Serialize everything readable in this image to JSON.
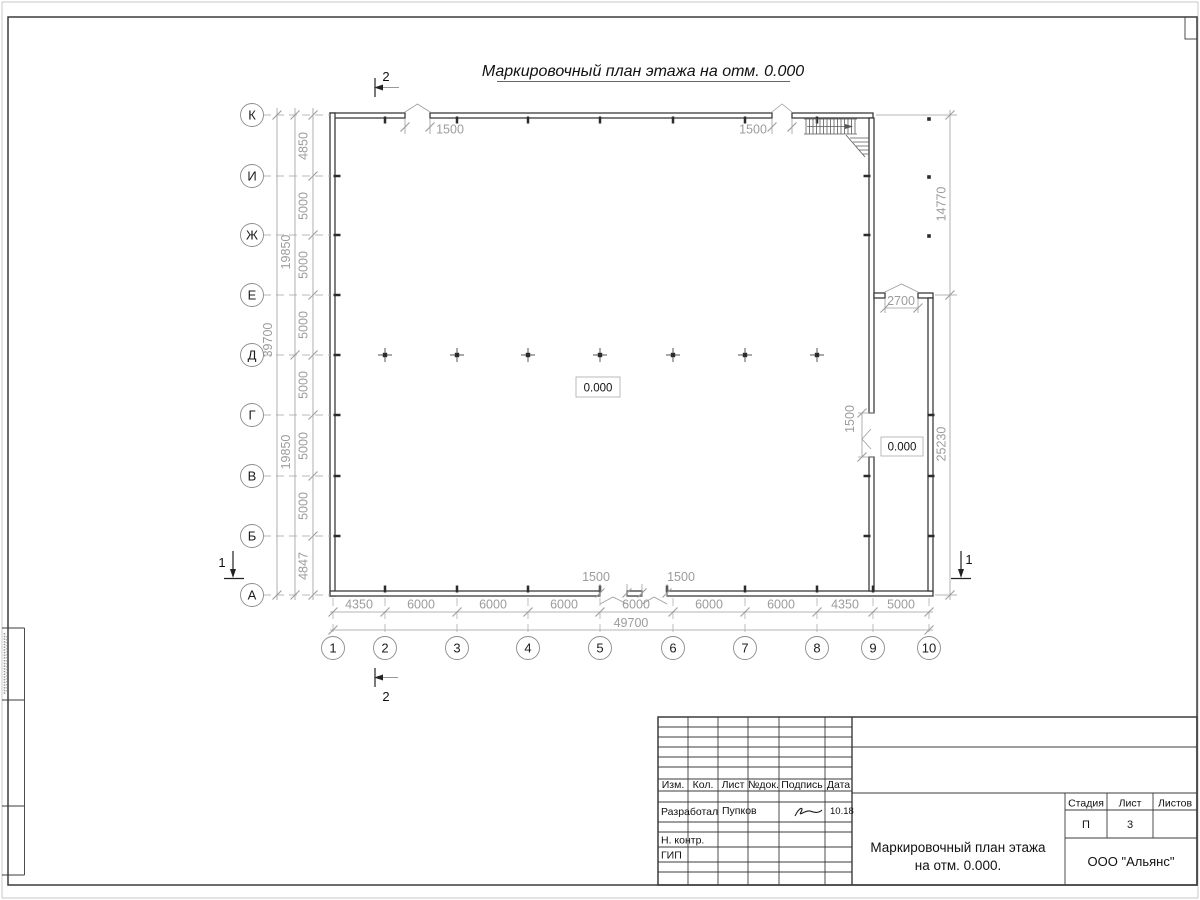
{
  "doc": {
    "title": "Маркировочный план этажа на отм. 0.000"
  },
  "plan": {
    "axes_bottom": [
      "1",
      "2",
      "3",
      "4",
      "5",
      "6",
      "7",
      "8",
      "9",
      "10"
    ],
    "axes_left": [
      "К",
      "И",
      "Ж",
      "Е",
      "Д",
      "Г",
      "В",
      "Б",
      "А"
    ],
    "dims_left": [
      "4850",
      "5000",
      "5000",
      "5000",
      "5000",
      "5000",
      "5000",
      "4847"
    ],
    "dims_left_sub": [
      "19850",
      "19850"
    ],
    "dim_left_total": "39700",
    "dims_bottom": [
      "4350",
      "6000",
      "6000",
      "6000",
      "6000",
      "6000",
      "6000",
      "4350",
      "5000"
    ],
    "dim_bottom_total": "49700",
    "dim_right_upper": "14770",
    "dim_right_lower": "25230",
    "opening_top_left": "1500",
    "opening_top_right": "1500",
    "opening_bottom_left": "1500",
    "opening_bottom_right": "1500",
    "opening_side": "1500",
    "opening_annex": "2700",
    "level_center": "0.000",
    "level_annex": "0.000",
    "section_1": "1",
    "section_2": "2"
  },
  "titleblock": {
    "col_izm": "Изм.",
    "col_kol": "Кол.",
    "col_list": "Лист",
    "col_ndok": "№док.",
    "col_podpis": "Подпись",
    "col_data": "Дата",
    "row_developer_role": "Разработал",
    "row_developer_name": "Пупков",
    "row_developer_date": "10.18",
    "row_ncontr": "Н. контр.",
    "row_gip": "ГИП",
    "doc_title_line1": "Маркировочный план этажа",
    "doc_title_line2": "на отм. 0.000.",
    "stage_label": "Стадия",
    "sheet_label": "Лист",
    "sheets_label": "Листов",
    "stage_value": "П",
    "sheet_value": "3",
    "company": "ООО \"Альянс\""
  }
}
